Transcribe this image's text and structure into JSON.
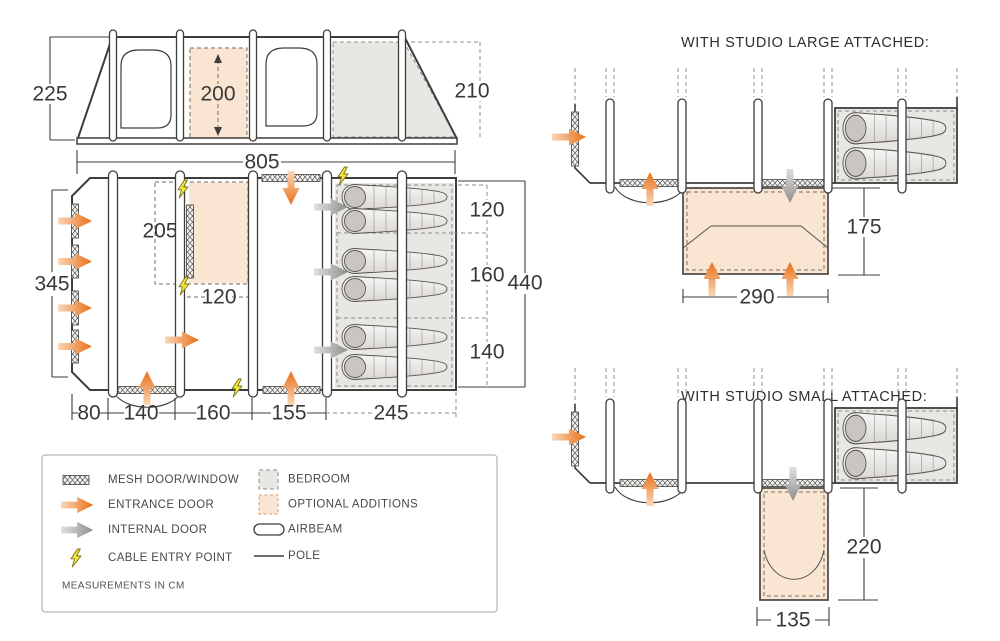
{
  "side_view": {
    "height_front": "225",
    "inner_height": "200",
    "height_rear": "210",
    "length": "805"
  },
  "floor_plan": {
    "front_width": "345",
    "utility_depth": "205",
    "utility_width": "120",
    "bedroom_widths": [
      "120",
      "160",
      "140"
    ],
    "total_depth": "440",
    "sections": [
      "80",
      "140",
      "160",
      "155",
      "245"
    ]
  },
  "studio_large": {
    "title": "WITH STUDIO LARGE ATTACHED:",
    "width": "290",
    "depth": "175"
  },
  "studio_small": {
    "title": "WITH STUDIO SMALL ATTACHED:",
    "width": "135",
    "depth": "220"
  },
  "legend": {
    "items": [
      {
        "icon": "mesh-door-window-icon",
        "label": "MESH DOOR/WINDOW"
      },
      {
        "icon": "entrance-door-icon",
        "label": "ENTRANCE DOOR"
      },
      {
        "icon": "internal-door-icon",
        "label": "INTERNAL DOOR"
      },
      {
        "icon": "cable-entry-point-icon",
        "label": "CABLE ENTRY POINT"
      },
      {
        "icon": "bedroom-icon",
        "label": "BEDROOM"
      },
      {
        "icon": "optional-additions-icon",
        "label": "OPTIONAL ADDITIONS"
      },
      {
        "icon": "airbeam-icon",
        "label": "AIRBEAM"
      },
      {
        "icon": "pole-icon",
        "label": "POLE"
      }
    ],
    "note": "MEASUREMENTS IN CM"
  },
  "colors": {
    "entrance_door_orange": "#ec6f17",
    "internal_door_gray": "#8f8e8c",
    "optional_addition_peach": "#fae5d2",
    "bedroom_gray": "#e9e7e3",
    "cable_yellow": "#f4e63e",
    "line_dark": "#3f3d3b"
  }
}
